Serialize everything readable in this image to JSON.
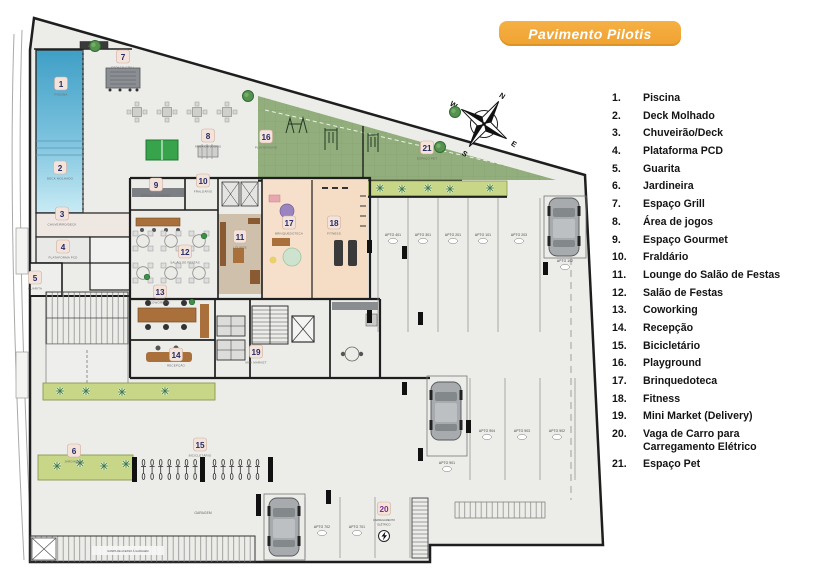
{
  "title": {
    "badge": "Pavimento Pilotis"
  },
  "compass": {
    "n": "N",
    "s": "S",
    "e": "E",
    "w": "W"
  },
  "colors": {
    "accent_orange": "#F2A93B",
    "badge_number_navy": "#242B66",
    "badge_number_purple": "#7B2E8E",
    "badge_background": "#F4E3DA",
    "grass_green": "#93AE7D",
    "planter_green": "#C8D687",
    "pool_blue": "#49A8D0",
    "floor_gray": "#ECECE9",
    "room_pink": "#F7E0CB",
    "wall_black": "#1E1E1E"
  },
  "legend": {
    "items": [
      {
        "n": "1.",
        "label": "Piscina"
      },
      {
        "n": "2.",
        "label": "Deck Molhado"
      },
      {
        "n": "3.",
        "label": "Chuveirão/Deck"
      },
      {
        "n": "4.",
        "label": "Plataforma PCD"
      },
      {
        "n": "5.",
        "label": "Guarita"
      },
      {
        "n": "6.",
        "label": "Jardineira"
      },
      {
        "n": "7.",
        "label": "Espaço Grill"
      },
      {
        "n": "8.",
        "label": "Área de jogos"
      },
      {
        "n": "9.",
        "label": "Espaço Gourmet"
      },
      {
        "n": "10.",
        "label": "Fraldário"
      },
      {
        "n": "11.",
        "label": "Lounge do Salão de Festas"
      },
      {
        "n": "12.",
        "label": "Salão de Festas"
      },
      {
        "n": "13.",
        "label": "Coworking"
      },
      {
        "n": "14.",
        "label": "Recepção"
      },
      {
        "n": "15.",
        "label": "Bicicletário"
      },
      {
        "n": "16.",
        "label": "Playground"
      },
      {
        "n": "17.",
        "label": "Brinquedoteca"
      },
      {
        "n": "18.",
        "label": "Fitness"
      },
      {
        "n": "19.",
        "label": "Mini Market (Delivery)"
      },
      {
        "n": "20.",
        "label": "Vaga de Carro para Carregamento Elétrico"
      },
      {
        "n": "21.",
        "label": "Espaço Pet"
      }
    ]
  },
  "plan": {
    "badges": [
      {
        "n": "1",
        "x": 61,
        "y": 84,
        "c": "PISCINA"
      },
      {
        "n": "2",
        "x": 60,
        "y": 168,
        "c": "DECK MOLHADO"
      },
      {
        "n": "3",
        "x": 62,
        "y": 214,
        "c": "CHUVEIRÃO/DECK"
      },
      {
        "n": "4",
        "x": 63,
        "y": 247,
        "c": "PLATAFORMA PCD"
      },
      {
        "n": "5",
        "x": 35,
        "y": 278,
        "c": "GUARITA"
      },
      {
        "n": "6",
        "x": 74,
        "y": 451,
        "c": "JARDINEIRA"
      },
      {
        "n": "7",
        "x": 123,
        "y": 57,
        "c": "ESPAÇO GRILL"
      },
      {
        "n": "8",
        "x": 208,
        "y": 136,
        "c": "ÁREA DE JOGOS"
      },
      {
        "n": "9",
        "x": 156,
        "y": 185,
        "c": "ESPAÇO GOURMET"
      },
      {
        "n": "10",
        "x": 203,
        "y": 181,
        "c": "FRALDÁRIO"
      },
      {
        "n": "11",
        "x": 240,
        "y": 237,
        "c": "LOUNGE"
      },
      {
        "n": "12",
        "x": 185,
        "y": 252,
        "c": "SALÃO DE FESTAS"
      },
      {
        "n": "13",
        "x": 160,
        "y": 292,
        "c": "COWORKING"
      },
      {
        "n": "14",
        "x": 176,
        "y": 355,
        "c": "RECEPÇÃO"
      },
      {
        "n": "15",
        "x": 200,
        "y": 445,
        "c": "BICICLETÁRIO"
      },
      {
        "n": "16",
        "x": 266,
        "y": 137,
        "c": "PLAYGROUND"
      },
      {
        "n": "17",
        "x": 289,
        "y": 223,
        "c": "BRINQUEDOTECA"
      },
      {
        "n": "18",
        "x": 334,
        "y": 223,
        "c": "FITNESS"
      },
      {
        "n": "19",
        "x": 256,
        "y": 352,
        "c": "MINI MARKET"
      },
      {
        "n": "20",
        "x": 384,
        "y": 509,
        "c": "",
        "p": true
      },
      {
        "n": "21",
        "x": 427,
        "y": 148,
        "c": "ESPAÇO PET"
      }
    ],
    "apto": [
      {
        "t": "APTO 401",
        "x": 393,
        "y": 236
      },
      {
        "t": "APTO 301",
        "x": 423,
        "y": 236
      },
      {
        "t": "APTO 201",
        "x": 453,
        "y": 236
      },
      {
        "t": "APTO 101",
        "x": 483,
        "y": 236
      },
      {
        "t": "APTO 203",
        "x": 519,
        "y": 236
      },
      {
        "t": "APTO 102",
        "x": 565,
        "y": 262
      },
      {
        "t": "APTO 904",
        "x": 487,
        "y": 432
      },
      {
        "t": "APTO 903",
        "x": 522,
        "y": 432
      },
      {
        "t": "APTO 902",
        "x": 557,
        "y": 432
      },
      {
        "t": "APTO 901",
        "x": 447,
        "y": 464
      },
      {
        "t": "APTO 702",
        "x": 322,
        "y": 528
      },
      {
        "t": "APTO 701",
        "x": 357,
        "y": 528
      }
    ],
    "texts": {
      "garagem": "GARAGEM",
      "ramp": "RAMPA DE ACESSO À GARAGEM",
      "access": "ACESSO",
      "ev1": "CARREGAMENTO",
      "ev2": "ELÉTRICO"
    },
    "bikes": {
      "groups": [
        {
          "x": 141,
          "y": 459,
          "count": 7,
          "step": 8.6
        },
        {
          "x": 212,
          "y": 459,
          "count": 6,
          "step": 8.6
        }
      ]
    },
    "tables": {
      "round": [
        [
          143,
          241
        ],
        [
          171,
          241
        ],
        [
          199,
          241
        ],
        [
          143,
          273
        ],
        [
          171,
          273
        ],
        [
          199,
          273
        ]
      ],
      "square": [
        [
          137,
          112
        ],
        [
          167,
          112
        ],
        [
          197,
          112
        ],
        [
          227,
          112
        ]
      ]
    },
    "plants": [
      [
        380,
        188
      ],
      [
        402,
        189
      ],
      [
        428,
        188
      ],
      [
        450,
        189
      ],
      [
        490,
        188
      ],
      [
        60,
        391
      ],
      [
        86,
        391
      ],
      [
        122,
        392
      ],
      [
        165,
        391
      ],
      [
        57,
        466
      ],
      [
        80,
        463
      ],
      [
        104,
        466
      ],
      [
        126,
        464
      ]
    ],
    "trees": [
      [
        95,
        46
      ],
      [
        248,
        96
      ],
      [
        455,
        112
      ],
      [
        440,
        147
      ]
    ],
    "pots": [
      [
        204,
        236
      ],
      [
        147,
        277
      ],
      [
        192,
        302
      ]
    ]
  }
}
